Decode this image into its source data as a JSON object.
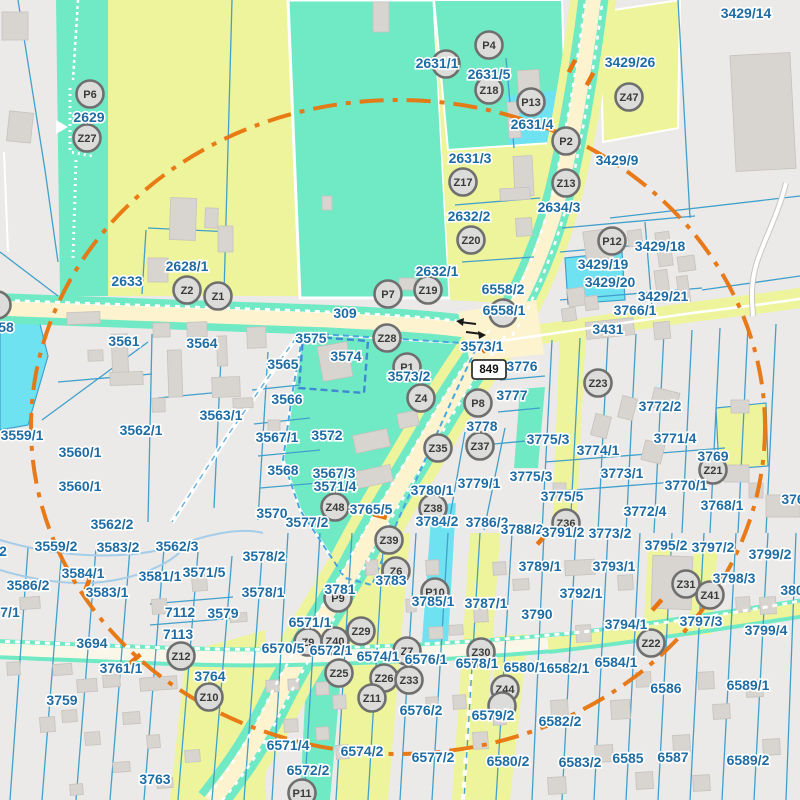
{
  "map": {
    "shield": {
      "label": "849"
    },
    "colors": {
      "bg": "#ebeae8",
      "yellow": "#eef49b",
      "teal": "#70e9c5",
      "cyan": "#6fe2f2",
      "road_cream": "#fdf3cf",
      "road_white": "#fbf7e8",
      "road_yellow": "#eef49b",
      "line_blue": "#42a0cc",
      "stream_blue": "#a5cde9",
      "label_blue": "#1e6ca3",
      "marker_fill": "#dcdcda",
      "marker_stroke": "#6f6f6f",
      "marker_text": "#3a3a3a",
      "orange": "#e8740e",
      "building": "#d8d4d0",
      "building_edge": "#c7c2bd"
    },
    "labels": [
      {
        "t": "3429/14",
        "x": 746,
        "y": 13
      },
      {
        "t": "2631/1",
        "x": 437,
        "y": 63
      },
      {
        "t": "2631/5",
        "x": 489,
        "y": 74
      },
      {
        "t": "3429/26",
        "x": 630,
        "y": 62
      },
      {
        "t": "2631/4",
        "x": 532,
        "y": 124
      },
      {
        "t": "3429/9",
        "x": 617,
        "y": 160
      },
      {
        "t": "2631/3",
        "x": 470,
        "y": 158
      },
      {
        "t": "2632/2",
        "x": 469,
        "y": 216
      },
      {
        "t": "2634/3",
        "x": 559,
        "y": 207
      },
      {
        "t": "3429/18",
        "x": 660,
        "y": 246
      },
      {
        "t": "3429/19",
        "x": 603,
        "y": 264
      },
      {
        "t": "3429/20",
        "x": 610,
        "y": 282
      },
      {
        "t": "3429/21",
        "x": 663,
        "y": 296
      },
      {
        "t": "2628/1",
        "x": 187,
        "y": 266
      },
      {
        "t": "2633",
        "x": 127,
        "y": 281
      },
      {
        "t": "2632/1",
        "x": 437,
        "y": 271
      },
      {
        "t": "6558/2",
        "x": 503,
        "y": 289
      },
      {
        "t": "6558/1",
        "x": 504,
        "y": 310
      },
      {
        "t": "3431",
        "x": 608,
        "y": 329
      },
      {
        "t": "2629",
        "x": 89,
        "y": 117
      },
      {
        "t": "309",
        "x": 345,
        "y": 313
      },
      {
        "t": "58",
        "x": 6,
        "y": 327
      },
      {
        "t": "3561",
        "x": 124,
        "y": 341
      },
      {
        "t": "3564",
        "x": 202,
        "y": 343
      },
      {
        "t": "3575",
        "x": 311,
        "y": 338
      },
      {
        "t": "3574",
        "x": 346,
        "y": 356
      },
      {
        "t": "3565",
        "x": 283,
        "y": 364
      },
      {
        "t": "3573/1",
        "x": 482,
        "y": 346
      },
      {
        "t": "3573/2",
        "x": 409,
        "y": 376
      },
      {
        "t": "3776",
        "x": 522,
        "y": 366
      },
      {
        "t": "3766/1",
        "x": 635,
        "y": 310
      },
      {
        "t": "3777",
        "x": 512,
        "y": 395
      },
      {
        "t": "3778",
        "x": 482,
        "y": 426
      },
      {
        "t": "3566",
        "x": 287,
        "y": 399
      },
      {
        "t": "3572",
        "x": 327,
        "y": 435
      },
      {
        "t": "3563/1",
        "x": 221,
        "y": 415
      },
      {
        "t": "3562/1",
        "x": 141,
        "y": 430
      },
      {
        "t": "3559/1",
        "x": 22,
        "y": 435
      },
      {
        "t": "3560/1",
        "x": 80,
        "y": 452
      },
      {
        "t": "3560/1",
        "x": 80,
        "y": 486
      },
      {
        "t": "3567/1",
        "x": 277,
        "y": 437
      },
      {
        "t": "3567/3",
        "x": 334,
        "y": 473
      },
      {
        "t": "3568",
        "x": 283,
        "y": 470
      },
      {
        "t": "3571/4",
        "x": 335,
        "y": 486
      },
      {
        "t": "3765/5",
        "x": 371,
        "y": 509
      },
      {
        "t": "3570",
        "x": 272,
        "y": 513
      },
      {
        "t": "3577/2",
        "x": 307,
        "y": 522
      },
      {
        "t": "3780/1",
        "x": 432,
        "y": 490
      },
      {
        "t": "3779/1",
        "x": 479,
        "y": 483
      },
      {
        "t": "3775/3",
        "x": 548,
        "y": 439
      },
      {
        "t": "3775/3",
        "x": 531,
        "y": 476
      },
      {
        "t": "3775/5",
        "x": 562,
        "y": 496
      },
      {
        "t": "3774/1",
        "x": 598,
        "y": 450
      },
      {
        "t": "3772/2",
        "x": 660,
        "y": 406
      },
      {
        "t": "3771/4",
        "x": 675,
        "y": 438
      },
      {
        "t": "3773/1",
        "x": 622,
        "y": 473
      },
      {
        "t": "3770/1",
        "x": 686,
        "y": 485
      },
      {
        "t": "3772/4",
        "x": 645,
        "y": 511
      },
      {
        "t": "3768/1",
        "x": 722,
        "y": 505
      },
      {
        "t": "3769",
        "x": 713,
        "y": 456
      },
      {
        "t": "376",
        "x": 793,
        "y": 499
      },
      {
        "t": "3784/2",
        "x": 437,
        "y": 521
      },
      {
        "t": "3786/2",
        "x": 487,
        "y": 522
      },
      {
        "t": "3788/2",
        "x": 522,
        "y": 529
      },
      {
        "t": "3791/2",
        "x": 563,
        "y": 532
      },
      {
        "t": "3773/2",
        "x": 610,
        "y": 533
      },
      {
        "t": "3789/1",
        "x": 540,
        "y": 566
      },
      {
        "t": "3793/1",
        "x": 614,
        "y": 566
      },
      {
        "t": "3792/1",
        "x": 581,
        "y": 593
      },
      {
        "t": "3790",
        "x": 537,
        "y": 614
      },
      {
        "t": "3795/2",
        "x": 666,
        "y": 545
      },
      {
        "t": "3797/2",
        "x": 713,
        "y": 547
      },
      {
        "t": "3799/2",
        "x": 770,
        "y": 554
      },
      {
        "t": "3798/3",
        "x": 734,
        "y": 578
      },
      {
        "t": "3797/3",
        "x": 701,
        "y": 621
      },
      {
        "t": "3794/1",
        "x": 626,
        "y": 624
      },
      {
        "t": "3799/4",
        "x": 766,
        "y": 630
      },
      {
        "t": "6584/1",
        "x": 616,
        "y": 662
      },
      {
        "t": "6582/1",
        "x": 568,
        "y": 668
      },
      {
        "t": "6580/1",
        "x": 525,
        "y": 667
      },
      {
        "t": "6578/1",
        "x": 477,
        "y": 663
      },
      {
        "t": "6576/1",
        "x": 426,
        "y": 659
      },
      {
        "t": "6574/1",
        "x": 378,
        "y": 656
      },
      {
        "t": "6572/1",
        "x": 331,
        "y": 650
      },
      {
        "t": "6570/5",
        "x": 283,
        "y": 648
      },
      {
        "t": "6571/1",
        "x": 310,
        "y": 622
      },
      {
        "t": "3781",
        "x": 340,
        "y": 589
      },
      {
        "t": "3783",
        "x": 391,
        "y": 580
      },
      {
        "t": "3785/1",
        "x": 433,
        "y": 601
      },
      {
        "t": "3787/1",
        "x": 486,
        "y": 603
      },
      {
        "t": "6576/2",
        "x": 421,
        "y": 710
      },
      {
        "t": "6579/2",
        "x": 493,
        "y": 715
      },
      {
        "t": "6582/2",
        "x": 560,
        "y": 721
      },
      {
        "t": "6580/2",
        "x": 508,
        "y": 761
      },
      {
        "t": "6577/2",
        "x": 433,
        "y": 757
      },
      {
        "t": "6574/2",
        "x": 362,
        "y": 751
      },
      {
        "t": "6572/2",
        "x": 308,
        "y": 770
      },
      {
        "t": "6571/4",
        "x": 288,
        "y": 745
      },
      {
        "t": "6583/2",
        "x": 580,
        "y": 762
      },
      {
        "t": "6585",
        "x": 628,
        "y": 758
      },
      {
        "t": "6587",
        "x": 673,
        "y": 757
      },
      {
        "t": "6589/2",
        "x": 748,
        "y": 760
      },
      {
        "t": "6589/1",
        "x": 748,
        "y": 685
      },
      {
        "t": "6586",
        "x": 666,
        "y": 688
      },
      {
        "t": "3763",
        "x": 155,
        "y": 779
      },
      {
        "t": "3759",
        "x": 62,
        "y": 700
      },
      {
        "t": "3761/1",
        "x": 121,
        "y": 668
      },
      {
        "t": "3764",
        "x": 210,
        "y": 676
      },
      {
        "t": "3694",
        "x": 92,
        "y": 643
      },
      {
        "t": "7113",
        "x": 178,
        "y": 634
      },
      {
        "t": "7112",
        "x": 180,
        "y": 612
      },
      {
        "t": "3579",
        "x": 223,
        "y": 613
      },
      {
        "t": "3583/1",
        "x": 107,
        "y": 592
      },
      {
        "t": "3581/1",
        "x": 160,
        "y": 576
      },
      {
        "t": "3571/5",
        "x": 204,
        "y": 572
      },
      {
        "t": "3584/1",
        "x": 83,
        "y": 573
      },
      {
        "t": "3586/2",
        "x": 28,
        "y": 585
      },
      {
        "t": "3583/2",
        "x": 118,
        "y": 547
      },
      {
        "t": "3559/2",
        "x": 56,
        "y": 546
      },
      {
        "t": "3562/3",
        "x": 177,
        "y": 546
      },
      {
        "t": "3562/2",
        "x": 112,
        "y": 524
      },
      {
        "t": "3578/2",
        "x": 264,
        "y": 556
      },
      {
        "t": "3578/1",
        "x": 263,
        "y": 592
      },
      {
        "t": "7/1",
        "x": 10,
        "y": 612
      },
      {
        "t": "2",
        "x": 3,
        "y": 551
      },
      {
        "t": "380",
        "x": 792,
        "y": 590
      }
    ],
    "markers": [
      {
        "t": "P6",
        "x": 90,
        "y": 94
      },
      {
        "t": "Z27",
        "x": 87,
        "y": 138
      },
      {
        "t": "Z2",
        "x": 187,
        "y": 290
      },
      {
        "t": "Z1",
        "x": 218,
        "y": 296
      },
      {
        "t": "P4",
        "x": 489,
        "y": 45
      },
      {
        "t": "",
        "x": 446,
        "y": 64
      },
      {
        "t": "Z18",
        "x": 489,
        "y": 90
      },
      {
        "t": "P13",
        "x": 531,
        "y": 102
      },
      {
        "t": "P2",
        "x": 566,
        "y": 141
      },
      {
        "t": "Z13",
        "x": 566,
        "y": 183
      },
      {
        "t": "Z47",
        "x": 629,
        "y": 97
      },
      {
        "t": "Z17",
        "x": 463,
        "y": 182
      },
      {
        "t": "Z20",
        "x": 471,
        "y": 240
      },
      {
        "t": "P12",
        "x": 612,
        "y": 241
      },
      {
        "t": "P7",
        "x": 388,
        "y": 294
      },
      {
        "t": "Z19",
        "x": 428,
        "y": 290
      },
      {
        "t": "",
        "x": 503,
        "y": 313
      },
      {
        "t": "Z28",
        "x": 387,
        "y": 338
      },
      {
        "t": "P1",
        "x": 407,
        "y": 367
      },
      {
        "t": "Z4",
        "x": 421,
        "y": 398
      },
      {
        "t": "Z23",
        "x": 598,
        "y": 383
      },
      {
        "t": "P8",
        "x": 478,
        "y": 403
      },
      {
        "t": "Z35",
        "x": 438,
        "y": 448
      },
      {
        "t": "Z37",
        "x": 480,
        "y": 446
      },
      {
        "t": "Z21",
        "x": 713,
        "y": 470
      },
      {
        "t": "Z48",
        "x": 335,
        "y": 507
      },
      {
        "t": "Z38",
        "x": 433,
        "y": 508
      },
      {
        "t": "Z39",
        "x": 389,
        "y": 540
      },
      {
        "t": "Z36",
        "x": 566,
        "y": 523
      },
      {
        "t": "Z6",
        "x": 396,
        "y": 571
      },
      {
        "t": "P10",
        "x": 435,
        "y": 592
      },
      {
        "t": "P9",
        "x": 338,
        "y": 598
      },
      {
        "t": "Z29",
        "x": 361,
        "y": 631
      },
      {
        "t": "Z9",
        "x": 308,
        "y": 642
      },
      {
        "t": "Z40",
        "x": 335,
        "y": 641
      },
      {
        "t": "Z25",
        "x": 339,
        "y": 673
      },
      {
        "t": "Z26",
        "x": 384,
        "y": 678
      },
      {
        "t": "Z33",
        "x": 409,
        "y": 680
      },
      {
        "t": "Z11",
        "x": 372,
        "y": 698
      },
      {
        "t": "Z7",
        "x": 407,
        "y": 651
      },
      {
        "t": "Z30",
        "x": 481,
        "y": 652
      },
      {
        "t": "Z44",
        "x": 505,
        "y": 689
      },
      {
        "t": "",
        "x": 502,
        "y": 706
      },
      {
        "t": "Z22",
        "x": 651,
        "y": 643
      },
      {
        "t": "Z31",
        "x": 686,
        "y": 584
      },
      {
        "t": "Z41",
        "x": 710,
        "y": 595
      },
      {
        "t": "Z12",
        "x": 181,
        "y": 656
      },
      {
        "t": "Z10",
        "x": 209,
        "y": 697
      },
      {
        "t": "P11",
        "x": 302,
        "y": 793
      },
      {
        "t": "4",
        "x": -3,
        "y": 305
      }
    ]
  }
}
